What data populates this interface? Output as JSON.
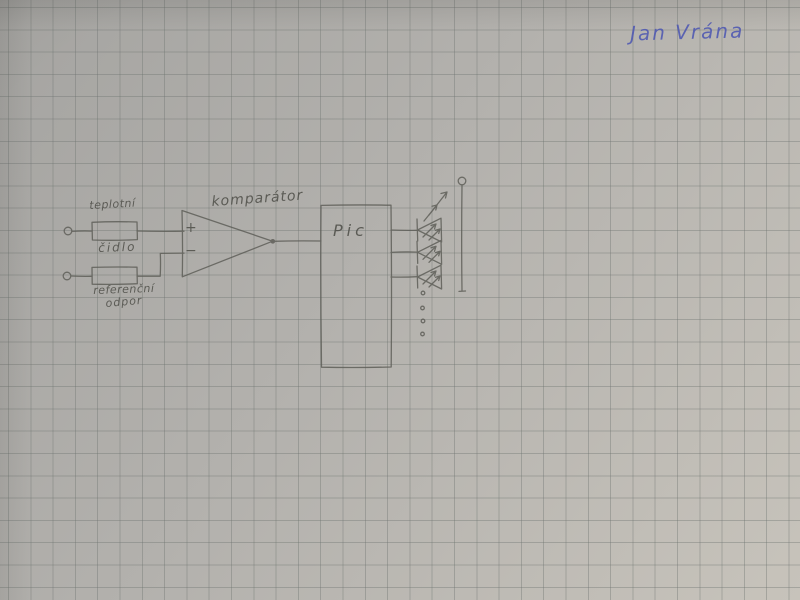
{
  "signature": {
    "text": "Jan Vrána"
  },
  "colors": {
    "paper": "#b2b0ac",
    "grid": "#6c726e",
    "pencil": "#5c5c56",
    "ink_blue": "#4b55b2"
  },
  "circuit": {
    "sensor_label_line1": "teplotní",
    "sensor_label_line2": "čidlo",
    "reference_label_line1": "referenční",
    "reference_label_line2": "odpor",
    "comparator_label": "komparátor",
    "comparator_plus": "+",
    "comparator_minus": "−",
    "mcu_label": "Pic"
  }
}
